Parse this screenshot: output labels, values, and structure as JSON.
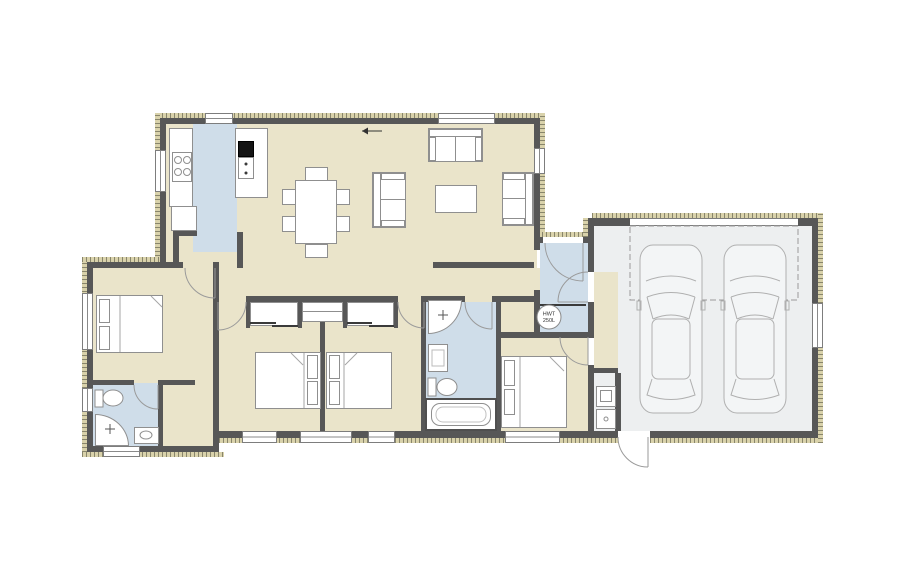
{
  "labels": {
    "hwt_line1": "HWT",
    "hwt_line2": "250L"
  },
  "colors": {
    "floor_living": "#eae4ca",
    "floor_wet_areas": "#cfdde9",
    "floor_garage": "#edeff0",
    "wall": "#575757",
    "exterior_cladding": "#d9d2ab",
    "fixture_outline": "#8f8f8f",
    "refrigerator_fill": "#141414"
  },
  "fixtures": [
    "refrigerator",
    "oven",
    "cooktop",
    "kitchen-island",
    "pantry",
    "dining-table",
    "dining-chair",
    "sofa",
    "coffee-table",
    "double-bed",
    "wardrobe",
    "walk-in-robe",
    "toilet",
    "corner-shower",
    "vanity",
    "bathtub",
    "hot-water-tank",
    "washing-machine",
    "dryer",
    "car",
    "garage-door"
  ]
}
